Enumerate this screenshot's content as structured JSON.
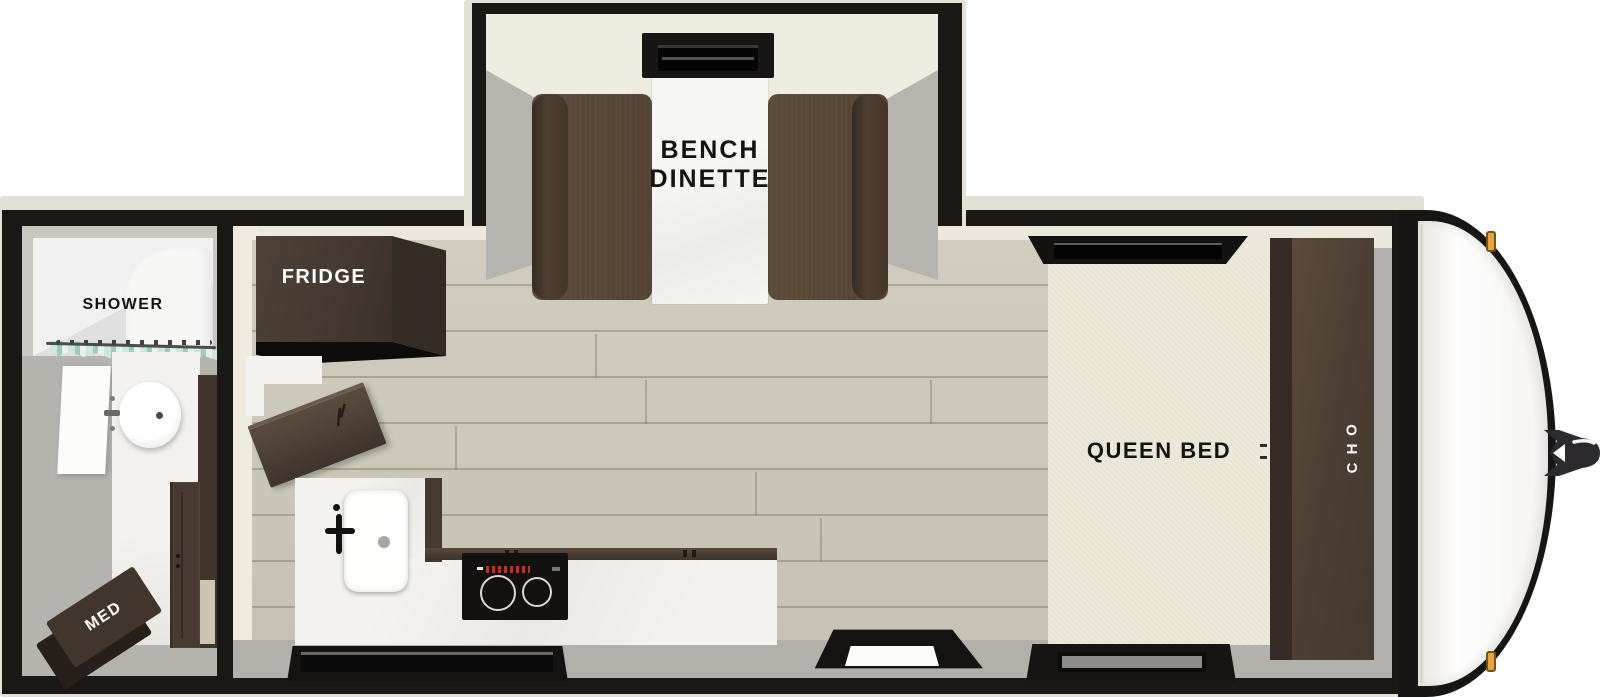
{
  "title": "Travel trailer floor plan",
  "rooms": {
    "dinette": {
      "label_line1": "BENCH",
      "label_line2": "DINETTE"
    },
    "kitchen": {
      "fridge_label": "FRIDGE"
    },
    "bathroom": {
      "shower_label": "SHOWER",
      "med_cabinet_label": "MED"
    },
    "bedroom": {
      "bed_label": "QUEEN BED",
      "overhead_cabinet_label": "OHC"
    }
  },
  "colors": {
    "wall_black": "#1a1815",
    "trim_cream": "#e3e0d6",
    "interior_cream": "#eeebdf",
    "floor_wood": "#cbc7b8",
    "floor_gray": "#b2b0aa",
    "cabinet_dark_brown": "#42352b",
    "bench_brown": "#5d4b3a",
    "bed_cream": "#e9e5d4",
    "counter_white": "#f2f1ed",
    "curtain_teal": "#9ccbb9",
    "marker_orange": "#e8a33b"
  }
}
